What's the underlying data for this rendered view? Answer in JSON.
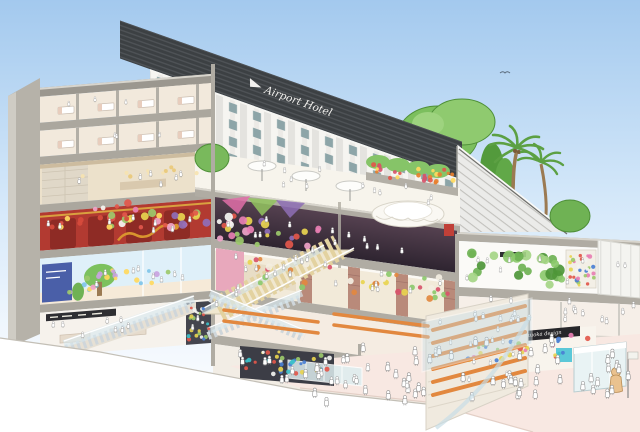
{
  "meta": {
    "alt": "Watercolor cutaway illustration of an airport hotel and multi-level shopping complex with escalators, rooftop garden and crowds"
  },
  "signs": {
    "hotel_name": "Airport Hotel",
    "design_shop": "Fukuoka design",
    "cafe": "cafe"
  },
  "palette": {
    "sky_top": "#a3c9ee",
    "sky_mid": "#d3e7f9",
    "sky_low": "#eff6fd",
    "paper": "#ffffff",
    "slab": "#b0aca3",
    "slab_light": "#d8d5cd",
    "structure": "#9b978f",
    "parapet": "#3c4043",
    "facade": "#f6f5f1",
    "facade_stripe": "#e4e3df",
    "window": "#8da5a8",
    "roof": "#ebebe9",
    "roof_line": "#c2c1bd",
    "tree": "#79b95c",
    "tree_dark": "#4e8f37",
    "tree_light": "#9ed37f",
    "palm": "#5ca043",
    "trunk": "#9b7a52",
    "terrace_floor": "#f7f4ec",
    "umbrella": "#fdfdfb",
    "dark_floor": "#4a3741",
    "dark_floor_deep": "#2e2430",
    "chinatown": "#b23a31",
    "chinatown_dark": "#8e2b25",
    "gold": "#d9a13f",
    "lobby": "#ece1cb",
    "kids_wall": "#dff0f9",
    "retail": "#f6f2ec",
    "market": "#f2ead9",
    "brick": "#b98a7a",
    "garden_bg": "#fbfaf7",
    "panel": "#f4f4f0",
    "glass": "#cfe4ee",
    "handrail": "#ffffff",
    "step": "#e3d2a0",
    "bench": "#e2883f",
    "floor_pink": "#f8e8e2",
    "sign_black": "#26262a",
    "sign_text": "#f2f1ee",
    "crowd_fill": "#ffffff",
    "crowd_line": "#8d8d8d",
    "kiosk": "#e9f3f4",
    "teal": "#5bc8d8",
    "statue": "#eac28f"
  },
  "illustration": {
    "clusters": [
      {
        "x": 95,
        "y": 198,
        "w": 225,
        "h": 26,
        "slope": 0.13,
        "n": 52,
        "rmin": 2,
        "rmax": 4.5,
        "colors": [
          "#e87fb3",
          "#9cc96b",
          "#e8d44f",
          "#8f6fb8",
          "#f6f6f3",
          "#e2574b",
          "#f0a3c8"
        ]
      },
      {
        "x": 248,
        "y": 258,
        "w": 200,
        "h": 24,
        "slope": 0.1,
        "n": 40,
        "rmin": 2,
        "rmax": 3.5,
        "colors": [
          "#8cc96d",
          "#e8d44f",
          "#e2883f",
          "#d8536a",
          "#f3eee2"
        ]
      },
      {
        "x": 462,
        "y": 250,
        "w": 100,
        "h": 32,
        "slope": 0.05,
        "n": 24,
        "rmin": 3.5,
        "rmax": 6.5,
        "colors": [
          "#6fb254",
          "#8cc96d",
          "#4e9638",
          "#a5d585"
        ]
      },
      {
        "x": 570,
        "y": 255,
        "w": 26,
        "h": 30,
        "slope": 0.03,
        "n": 30,
        "rmin": 1.4,
        "rmax": 2.4,
        "colors": [
          "#e2574b",
          "#4a7fd4",
          "#e8d44f",
          "#9cc96b",
          "#e87fb3",
          "#f3f3f0"
        ]
      },
      {
        "x": 246,
        "y": 350,
        "w": 88,
        "h": 24,
        "slope": 0.06,
        "n": 34,
        "rmin": 1.4,
        "rmax": 2.6,
        "colors": [
          "#4a7fd4",
          "#e2574b",
          "#e8d44f",
          "#3dc0c9",
          "#f3f3f0",
          "#9cc96b"
        ]
      },
      {
        "x": 188,
        "y": 306,
        "w": 22,
        "h": 36,
        "slope": 0,
        "n": 24,
        "rmin": 1.3,
        "rmax": 2.2,
        "colors": [
          "#4a7fd4",
          "#e2574b",
          "#e8d44f",
          "#3dc0c9",
          "#f3f3f0",
          "#9cc96b"
        ]
      },
      {
        "x": 60,
        "y": 268,
        "w": 130,
        "h": 26,
        "slope": -0.08,
        "n": 22,
        "rmin": 1.8,
        "rmax": 3,
        "colors": [
          "#f0a3c8",
          "#9cc96b",
          "#ffd95e",
          "#7fc4e8",
          "#c9a3e0"
        ]
      },
      {
        "x": 368,
        "y": 162,
        "w": 88,
        "h": 14,
        "slope": 0.1,
        "n": 26,
        "rmin": 1.6,
        "rmax": 2.6,
        "colors": [
          "#e2574b",
          "#e87f2e",
          "#ffd95e",
          "#d8536a"
        ]
      },
      {
        "x": 48,
        "y": 220,
        "w": 150,
        "h": 12,
        "slope": -0.08,
        "n": 14,
        "rmin": 2,
        "rmax": 3,
        "colors": [
          "#d64b3c",
          "#e2574b",
          "#ffd95e"
        ]
      },
      {
        "x": 468,
        "y": 340,
        "w": 120,
        "h": 26,
        "slope": -0.07,
        "n": 30,
        "rmin": 1.6,
        "rmax": 2.8,
        "colors": [
          "#e2574b",
          "#4a7fd4",
          "#e8d44f",
          "#9cc96b",
          "#e87fb3",
          "#3dc0c9"
        ]
      },
      {
        "x": 60,
        "y": 176,
        "w": 140,
        "h": 8,
        "slope": -0.08,
        "n": 10,
        "rmin": 1.5,
        "rmax": 2.2,
        "colors": [
          "#e9c97a",
          "#f6e3b0"
        ]
      }
    ],
    "benches": [
      {
        "x1": 433,
        "y1": 330,
        "x2": 525,
        "y2": 306,
        "w": 4
      },
      {
        "x1": 433,
        "y1": 343,
        "x2": 525,
        "y2": 319,
        "w": 4
      },
      {
        "x1": 433,
        "y1": 356,
        "x2": 525,
        "y2": 332,
        "w": 4
      },
      {
        "x1": 433,
        "y1": 369,
        "x2": 525,
        "y2": 345,
        "w": 4
      },
      {
        "x1": 433,
        "y1": 382,
        "x2": 525,
        "y2": 358,
        "w": 4
      },
      {
        "x1": 433,
        "y1": 395,
        "x2": 525,
        "y2": 371,
        "w": 4
      },
      {
        "x1": 224,
        "y1": 310,
        "x2": 318,
        "y2": 322,
        "w": 3.5
      },
      {
        "x1": 224,
        "y1": 321,
        "x2": 318,
        "y2": 333,
        "w": 3.5
      },
      {
        "x1": 334,
        "y1": 314,
        "x2": 428,
        "y2": 326,
        "w": 3.5
      },
      {
        "x1": 334,
        "y1": 325,
        "x2": 428,
        "y2": 337,
        "w": 3.5
      }
    ],
    "crowds": [
      {
        "x": 305,
        "y": 352,
        "w": 330,
        "h": 58,
        "slope": -0.04,
        "n": 58,
        "s": 9
      },
      {
        "x": 460,
        "y": 300,
        "w": 175,
        "h": 24,
        "slope": 0.03,
        "n": 20,
        "s": 6.5
      },
      {
        "x": 235,
        "y": 352,
        "w": 215,
        "h": 28,
        "slope": 0.08,
        "n": 18,
        "s": 8
      },
      {
        "x": 220,
        "y": 255,
        "w": 225,
        "h": 28,
        "slope": 0.11,
        "n": 14,
        "s": 6
      },
      {
        "x": 222,
        "y": 208,
        "w": 220,
        "h": 26,
        "slope": 0.12,
        "n": 12,
        "s": 6
      },
      {
        "x": 235,
        "y": 158,
        "w": 210,
        "h": 24,
        "slope": 0.14,
        "n": 12,
        "s": 5.5
      },
      {
        "x": 48,
        "y": 226,
        "w": 155,
        "h": 16,
        "slope": -0.08,
        "n": 8,
        "s": 6
      },
      {
        "x": 48,
        "y": 278,
        "w": 155,
        "h": 18,
        "slope": -0.08,
        "n": 8,
        "s": 6
      },
      {
        "x": 48,
        "y": 326,
        "w": 150,
        "h": 16,
        "slope": -0.08,
        "n": 10,
        "s": 6
      },
      {
        "x": 52,
        "y": 182,
        "w": 150,
        "h": 14,
        "slope": -0.08,
        "n": 6,
        "s": 6
      },
      {
        "x": 215,
        "y": 300,
        "w": 110,
        "h": 8,
        "slope": -0.49,
        "n": 10,
        "s": 6
      },
      {
        "x": 432,
        "y": 316,
        "w": 92,
        "h": 90,
        "slope": -0.22,
        "n": 14,
        "s": 5.5
      },
      {
        "x": 465,
        "y": 258,
        "w": 160,
        "h": 24,
        "slope": 0.04,
        "n": 10,
        "s": 5.5
      },
      {
        "x": 55,
        "y": 104,
        "w": 140,
        "h": 8,
        "slope": -0.08,
        "n": 3,
        "s": 5
      },
      {
        "x": 55,
        "y": 140,
        "w": 140,
        "h": 8,
        "slope": -0.08,
        "n": 3,
        "s": 5
      }
    ]
  }
}
